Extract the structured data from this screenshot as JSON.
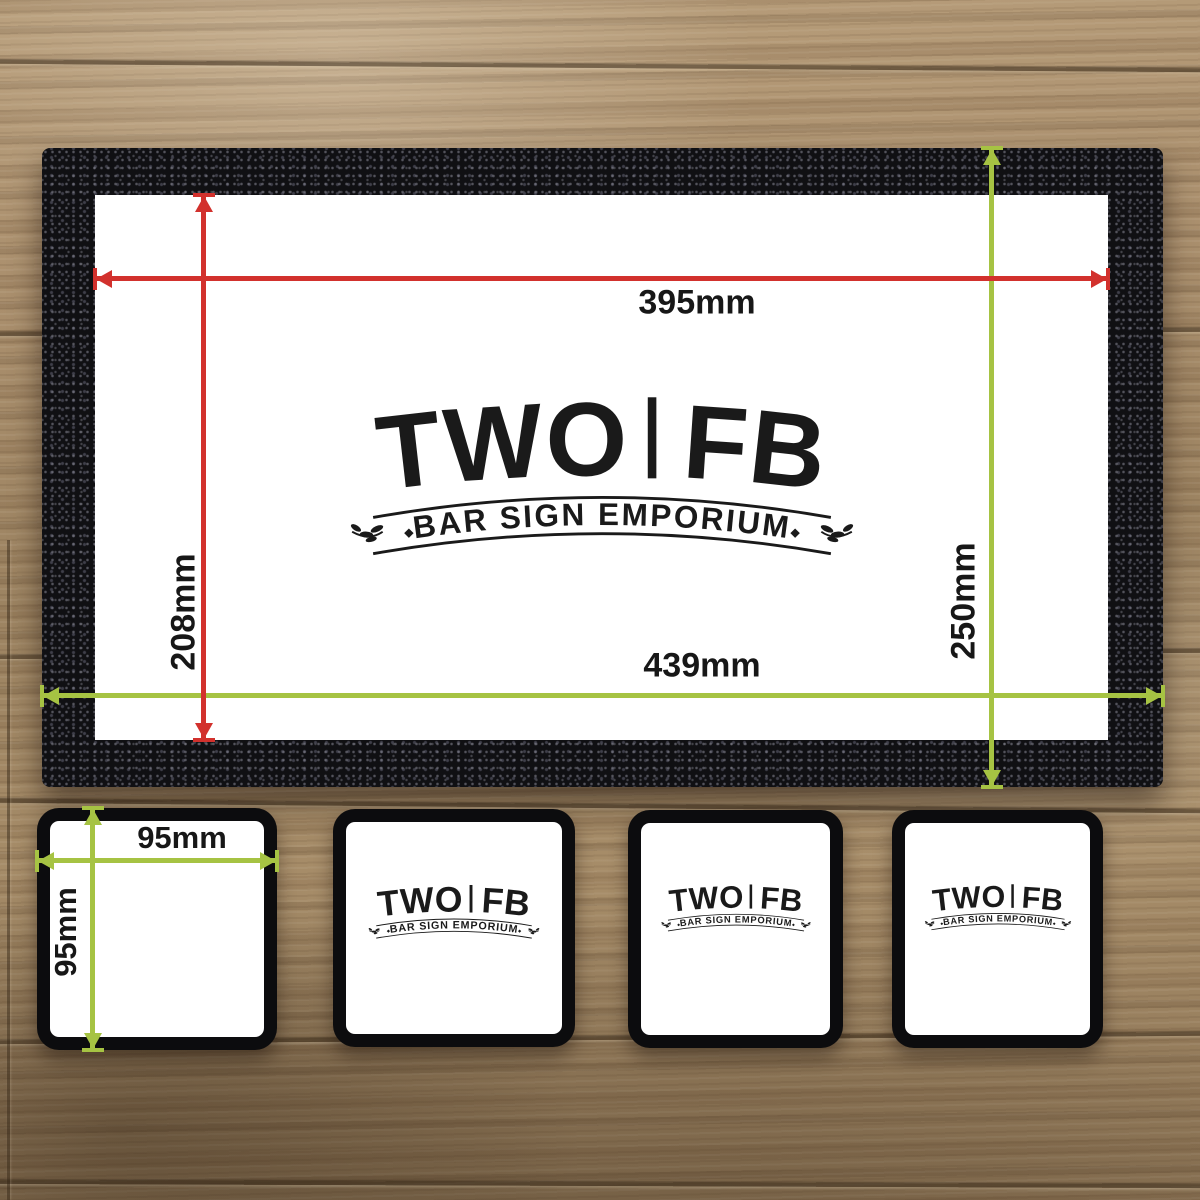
{
  "logo": {
    "wordmark": "TWO FB",
    "tagline": "BAR SIGN EMPORIUM"
  },
  "runner": {
    "print_width_label": "395mm",
    "print_height_label": "208mm",
    "overall_width_label": "439mm",
    "overall_height_label": "250mm"
  },
  "coaster": {
    "width_label": "95mm",
    "height_label": "95mm"
  },
  "colors": {
    "dimension_red": "#d2312d",
    "dimension_green": "#a6c343",
    "mat_black": "#131316",
    "print_area_white": "#ffffff",
    "wood_base": "#a68b68",
    "logo_ink": "#1a1a1a"
  }
}
